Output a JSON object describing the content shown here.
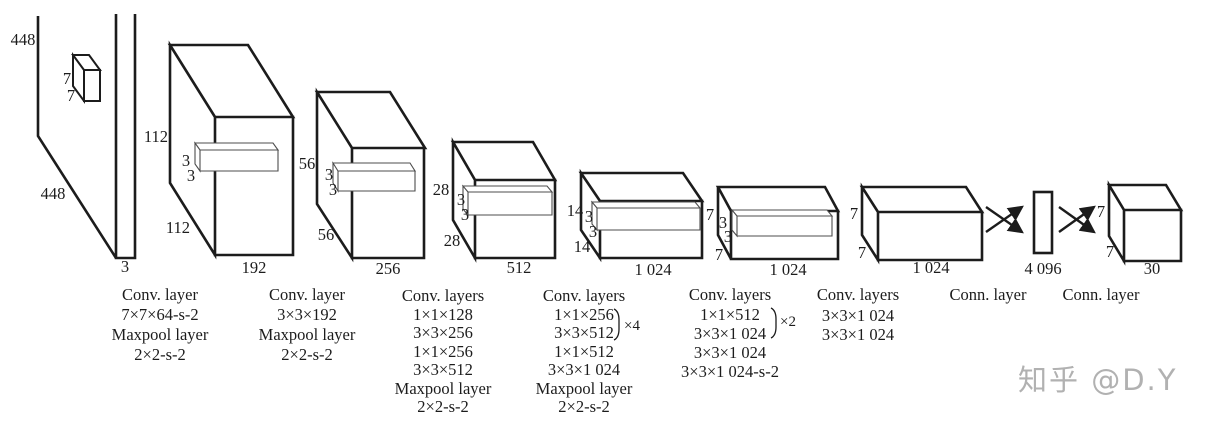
{
  "colors": {
    "line": "#1c1c1c",
    "text": "#1c1c1c",
    "slab_line": "#4d4d4d",
    "watermark": "#b1b1b1",
    "background": "#ffffff"
  },
  "input": {
    "height": "448",
    "width": "448",
    "channels": "3",
    "kernel_h": "7",
    "kernel_w": "7"
  },
  "boxes": [
    {
      "side": "112",
      "depth": "112",
      "front": "192",
      "kernel_h": "3",
      "kernel_w": "3"
    },
    {
      "side": "56",
      "depth": "56",
      "front": "256",
      "kernel_h": "3",
      "kernel_w": "3"
    },
    {
      "side": "28",
      "depth": "28",
      "front": "512",
      "kernel_h": "3",
      "kernel_w": "3"
    },
    {
      "side": "14",
      "depth": "14",
      "front": "1 024",
      "kernel_h": "3",
      "kernel_w": "3"
    },
    {
      "side": "7",
      "depth": "7",
      "front": "1 024",
      "kernel_h": "3",
      "kernel_w": "3"
    },
    {
      "side": "7",
      "depth": "7",
      "front": "1 024"
    }
  ],
  "fc": {
    "units": "4 096"
  },
  "output": {
    "side": "7",
    "depth": "7",
    "front": "30"
  },
  "columns": [
    {
      "lines": [
        "Conv. layer",
        "7×7×64-s-2",
        "Maxpool layer",
        "2×2-s-2"
      ]
    },
    {
      "lines": [
        "Conv. layer",
        "3×3×192",
        "Maxpool layer",
        "2×2-s-2"
      ]
    },
    {
      "lines": [
        "Conv. layers",
        "1×1×128",
        "3×3×256",
        "1×1×256",
        "3×3×512",
        "Maxpool layer",
        "2×2-s-2"
      ]
    },
    {
      "lines": [
        "Conv. layers",
        "1×1×256",
        "3×3×512",
        "1×1×512",
        "3×3×1 024",
        "Maxpool layer",
        "2×2-s-2"
      ],
      "repeat": "×4"
    },
    {
      "lines": [
        "Conv. layers",
        "1×1×512",
        "3×3×1 024",
        "3×3×1 024",
        "3×3×1 024-s-2"
      ],
      "repeat": "×2"
    },
    {
      "lines": [
        "Conv. layers",
        "3×3×1 024",
        "3×3×1 024"
      ]
    },
    {
      "lines": [
        "Conn. layer"
      ]
    },
    {
      "lines": [
        "Conn. layer"
      ]
    }
  ],
  "watermark": "知乎 @D.Y"
}
